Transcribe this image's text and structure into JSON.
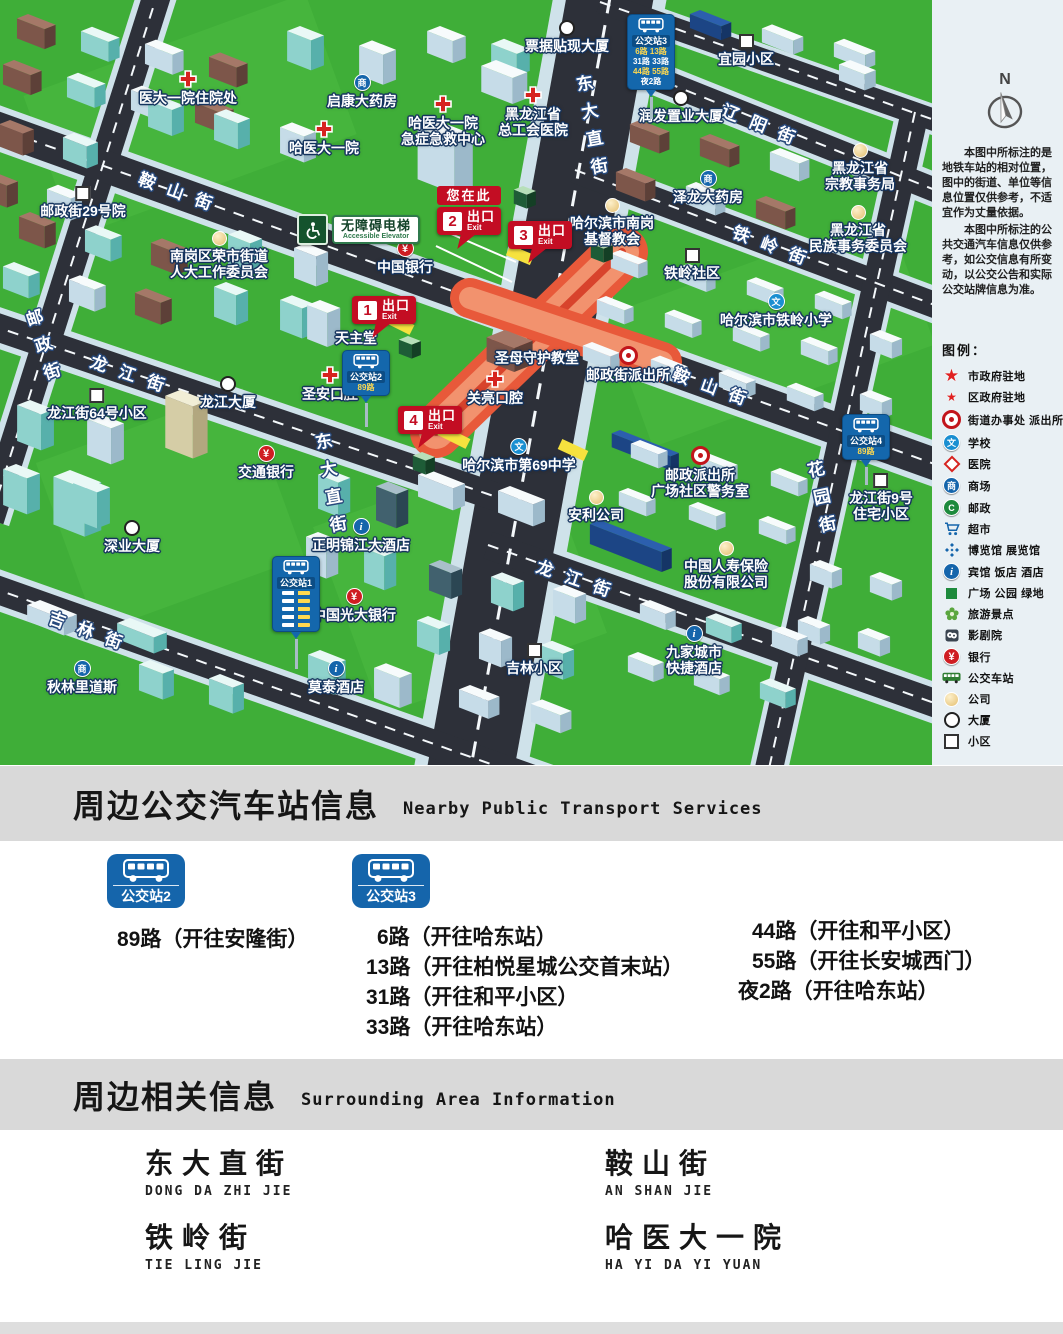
{
  "icons": {
    "mall_glyph": "商",
    "school_glyph": "文",
    "bank_glyph": "¥",
    "hotel_glyph": "i",
    "post_glyph": "C",
    "star_glyph": "★"
  },
  "map": {
    "compass_label": "N",
    "notes": [
      "本图中所标注的是地铁车站的相对位置，图中的街道、单位等信息位置仅供参考，不适宜作为丈量依据。",
      "本图中所标注的公共交通汽车信息仅供参考，如公交信息有所变动，以公交公告和实际公交站牌信息为准。"
    ],
    "legend_title": "图例：",
    "legend_items": [
      {
        "icon": "star-large",
        "label": "市政府驻地"
      },
      {
        "icon": "star-small",
        "label": "区政府驻地"
      },
      {
        "icon": "gov-circle",
        "label": "街道办事处 派出所"
      },
      {
        "icon": "school",
        "label": "学校"
      },
      {
        "icon": "hospital-diamond",
        "label": "医院"
      },
      {
        "icon": "mall",
        "label": "商场"
      },
      {
        "icon": "post",
        "label": "邮政"
      },
      {
        "icon": "market",
        "label": "超市"
      },
      {
        "icon": "expo",
        "label": "博览馆 展览馆"
      },
      {
        "icon": "hotel",
        "label": "宾馆 饭店 酒店"
      },
      {
        "icon": "park",
        "label": "广场 公园 绿地"
      },
      {
        "icon": "scenic",
        "label": "旅游景点"
      },
      {
        "icon": "theater",
        "label": "影剧院"
      },
      {
        "icon": "bank",
        "label": "银行"
      },
      {
        "icon": "bus",
        "label": "公交车站"
      },
      {
        "icon": "company",
        "label": "公司"
      },
      {
        "icon": "tower",
        "label": "大厦"
      },
      {
        "icon": "estate",
        "label": "小区"
      }
    ],
    "streets": [
      {
        "text": "鞍山街",
        "x": 182,
        "y": 192,
        "rot": 20
      },
      {
        "text": "鞍山街",
        "x": 716,
        "y": 387,
        "rot": 20
      },
      {
        "text": "铁岭街",
        "x": 776,
        "y": 246,
        "rot": 21
      },
      {
        "text": "辽阳街",
        "x": 765,
        "y": 125,
        "rot": 22
      },
      {
        "text": "龙江街",
        "x": 134,
        "y": 374,
        "rot": 19
      },
      {
        "text": "龙江街",
        "x": 580,
        "y": 579,
        "rot": 19
      },
      {
        "text": "吉林街",
        "x": 92,
        "y": 631,
        "rot": 20
      },
      {
        "text": "东大直街",
        "x": 591,
        "y": 130,
        "rot": -10,
        "vertical": true
      },
      {
        "text": "东大直街",
        "x": 330,
        "y": 488,
        "rot": -10,
        "vertical": true
      },
      {
        "text": "花园街",
        "x": 821,
        "y": 502,
        "rot": -12,
        "vertical": true
      },
      {
        "text": "邮政街",
        "x": 43,
        "y": 350,
        "rot": -18,
        "vertical": true
      }
    ],
    "places": [
      {
        "icon": "hospital-cross",
        "text": "医大一院住院处",
        "x": 188,
        "y": 70
      },
      {
        "icon": "hospital-cross",
        "text": "哈医大一院",
        "x": 324,
        "y": 120
      },
      {
        "icon": "hospital-cross",
        "text": "哈医大一院\n急症急救中心",
        "x": 443,
        "y": 95
      },
      {
        "icon": "hospital-cross",
        "text": "黑龙江省\n总工会医院",
        "x": 533,
        "y": 86
      },
      {
        "icon": "tower",
        "text": "票据贴现大厦",
        "x": 567,
        "y": 20
      },
      {
        "icon": "mall",
        "text": "启康大药房",
        "x": 362,
        "y": 74
      },
      {
        "icon": "estate",
        "text": "邮政街29号院",
        "x": 83,
        "y": 186
      },
      {
        "icon": "company",
        "text": "南岗区荣市街道\n人大工作委员会",
        "x": 219,
        "y": 231
      },
      {
        "icon": "estate",
        "text": "宜园小区",
        "x": 746,
        "y": 34
      },
      {
        "icon": "tower",
        "text": "润发置业大厦",
        "x": 681,
        "y": 90
      },
      {
        "icon": "mall",
        "text": "泽龙大药房",
        "x": 708,
        "y": 170
      },
      {
        "icon": "company",
        "text": "黑龙江省\n宗教事务局",
        "x": 860,
        "y": 143
      },
      {
        "icon": "company",
        "text": "黑龙江省\n民族事务委员会",
        "x": 858,
        "y": 205
      },
      {
        "icon": "company",
        "text": "哈尔滨市南岗\n基督教会",
        "x": 612,
        "y": 198
      },
      {
        "icon": "estate",
        "text": "铁岭社区",
        "x": 692,
        "y": 248
      },
      {
        "icon": "school",
        "text": "哈尔滨市铁岭小学",
        "x": 776,
        "y": 293
      },
      {
        "icon": "gov-circle",
        "text": "邮政街派出所",
        "x": 628,
        "y": 346
      },
      {
        "icon": "",
        "text": "圣母守护教堂",
        "x": 537,
        "y": 350
      },
      {
        "icon": "",
        "text": "天主堂",
        "x": 356,
        "y": 330
      },
      {
        "icon": "bank",
        "text": "中国银行",
        "x": 405,
        "y": 240
      },
      {
        "icon": "hospital-cross",
        "text": "圣安口腔",
        "x": 330,
        "y": 366
      },
      {
        "icon": "hospital-cross",
        "text": "关亮口腔",
        "x": 495,
        "y": 370
      },
      {
        "icon": "school",
        "text": "哈尔滨市第69中学",
        "x": 519,
        "y": 438
      },
      {
        "icon": "company",
        "text": "安利公司",
        "x": 596,
        "y": 490
      },
      {
        "icon": "gov-circle",
        "text": "邮政派出所\n广场社区警务室",
        "x": 700,
        "y": 446
      },
      {
        "icon": "estate",
        "text": "龙江街9号\n住宅小区",
        "x": 881,
        "y": 473
      },
      {
        "icon": "company",
        "text": "中国人寿保险\n股份有限公司",
        "x": 726,
        "y": 541
      },
      {
        "icon": "estate",
        "text": "龙江街64号小区",
        "x": 97,
        "y": 388
      },
      {
        "icon": "tower",
        "text": "龙江大厦",
        "x": 228,
        "y": 376
      },
      {
        "icon": "bank",
        "text": "交通银行",
        "x": 266,
        "y": 445
      },
      {
        "icon": "tower",
        "text": "深业大厦",
        "x": 132,
        "y": 520
      },
      {
        "icon": "hotel",
        "text": "正明锦江大酒店",
        "x": 361,
        "y": 518
      },
      {
        "icon": "bank",
        "text": "中国光大银行",
        "x": 354,
        "y": 588
      },
      {
        "icon": "hotel",
        "text": "莫泰酒店",
        "x": 336,
        "y": 660
      },
      {
        "icon": "estate",
        "text": "吉林小区",
        "x": 534,
        "y": 643
      },
      {
        "icon": "hotel",
        "text": "九家城市\n快捷酒店",
        "x": 694,
        "y": 625
      },
      {
        "icon": "mall",
        "text": "秋林里道斯",
        "x": 82,
        "y": 660
      }
    ],
    "exit_labels": {
      "here": "您在此",
      "exit_zh": "出口",
      "exit_en": "Exit"
    },
    "exits": [
      {
        "num": "1",
        "x": 352,
        "y": 296
      },
      {
        "num": "2",
        "x": 437,
        "y": 186,
        "you_are_here": true
      },
      {
        "num": "3",
        "x": 508,
        "y": 221
      },
      {
        "num": "4",
        "x": 398,
        "y": 406
      }
    ],
    "elevator": {
      "zh": "无障碍电梯",
      "en": "Accessible Elevator",
      "x": 297,
      "y": 214
    },
    "bus_signs": [
      {
        "name": "公交站3",
        "x": 651,
        "y": 14,
        "rows": [
          "6路 13路",
          "31路 33路",
          "44路 55路",
          "夜2路"
        ],
        "pole": 22
      },
      {
        "name": "公交站2",
        "x": 366,
        "y": 350,
        "rows": [
          "89路"
        ],
        "pole": 24
      },
      {
        "name": "公交站1",
        "x": 296,
        "y": 556,
        "blank_rows": 5,
        "pole": 30
      },
      {
        "name": "公交站4",
        "x": 866,
        "y": 414,
        "rows": [
          "89路"
        ],
        "pole": 18
      }
    ]
  },
  "transport_section": {
    "title_zh": "周边公交汽车站信息",
    "title_en": "Nearby Public Transport Services",
    "stations": [
      {
        "name": "公交站2",
        "routes": [
          "89路（开往安隆街）"
        ]
      },
      {
        "name": "公交站3",
        "routes": [
          "6路（开往哈东站）",
          "13路（开往柏悦星城公交首末站）",
          "31路（开往和平小区）",
          "33路（开往哈东站）"
        ],
        "routes_extra": [
          "44路（开往和平小区）",
          "55路（开往长安城西门）",
          "夜2路（开往哈东站）"
        ]
      }
    ]
  },
  "surrounding_section": {
    "title_zh": "周边相关信息",
    "title_en": "Surrounding Area Information",
    "entries": [
      {
        "zh": "东大直街",
        "en": "DONG DA ZHI JIE"
      },
      {
        "zh": "鞍山街",
        "en": "AN SHAN JIE"
      },
      {
        "zh": "铁岭街",
        "en": "TIE LING JIE"
      },
      {
        "zh": "哈医大一院",
        "en": "HA YI DA YI YUAN"
      }
    ]
  },
  "colors": {
    "map_green": "#3fae38",
    "road": "#2d3039",
    "sidewalk": "#cfe2ea",
    "station_orange": "#e8593a",
    "exit_red": "#c30d23",
    "bus_blue": "#1565ab",
    "band_gray": "#d9d9d9"
  }
}
